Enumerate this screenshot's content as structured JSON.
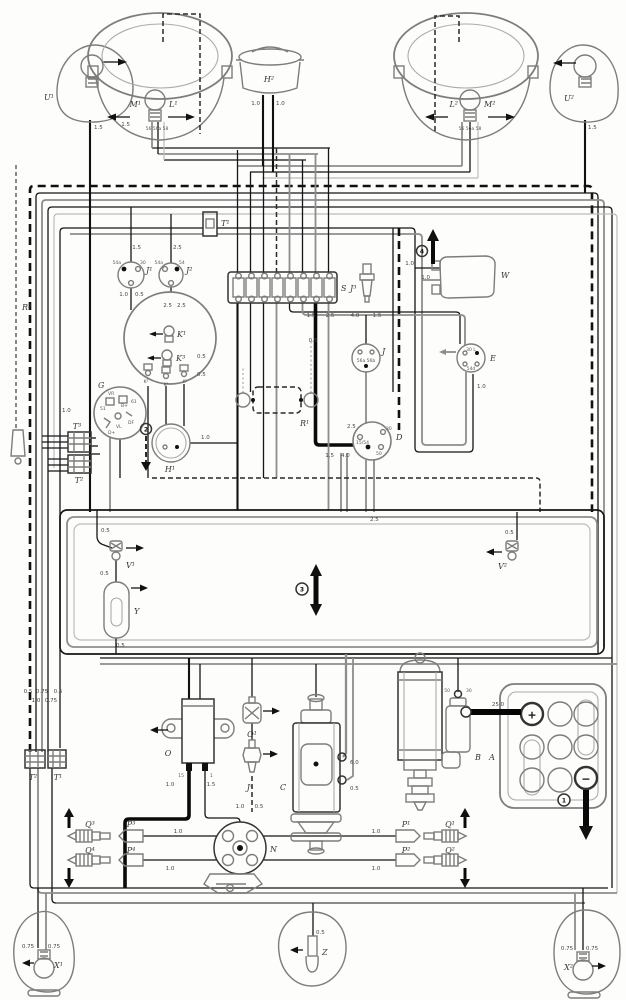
{
  "diagram": {
    "type": "wiring-schematic",
    "subject": "Volkswagen Type 1 (Beetle) electrical wiring diagram"
  },
  "components": {
    "front_turn_left": {
      "label": "U¹"
    },
    "front_turn_right": {
      "label": "U²"
    },
    "headlight_left": {
      "dim_bulb": "M¹",
      "main_bulb": "L¹",
      "terminals": "56 56a 58"
    },
    "headlight_right": {
      "main_bulb": "L²",
      "dim_bulb": "M²",
      "terminals": "56 56a 58"
    },
    "horn": {
      "label": "H²"
    },
    "horn_ring": {
      "label": "H¹"
    },
    "antenna": {
      "label": "R²"
    },
    "radio": {
      "label": "R¹"
    },
    "connector_top": {
      "label": "T¹"
    },
    "switch_j1": {
      "label": "J¹",
      "t_left": "54a",
      "t_right": "30"
    },
    "switch_j2": {
      "label": "J²",
      "t_left": "54a",
      "t_right": "54"
    },
    "fusebox": {
      "label": "S"
    },
    "plug_j3": {
      "label": "J³"
    },
    "wiper_motor": {
      "label": "W"
    },
    "wiper_switch": {
      "label": "E",
      "t_top": "30 L",
      "t_bottom": "54d"
    },
    "speedometer": {
      "lamp1": "K¹",
      "lamp2": "K³",
      "t1": "K²",
      "t2": "K⁴",
      "t3": "K⁵"
    },
    "dimmer_switch": {
      "label": "J",
      "terminals": "56a 56b"
    },
    "regulator": {
      "group": "G",
      "label": "VR",
      "t51": "51",
      "tbplus": "B+",
      "t61": "61",
      "tdf": "DF",
      "tdplus": "D+",
      "tvl": "VL"
    },
    "connector_t3": {
      "label": "T³"
    },
    "connector_t2": {
      "label": "T²"
    },
    "ignition_switch": {
      "label": "D",
      "t30": "30",
      "t1554": "15/54",
      "t50": "50"
    },
    "sender_v1": {
      "label": "V¹"
    },
    "sender_v2": {
      "label": "V²"
    },
    "semaphore": {
      "label": "Y"
    },
    "coil": {
      "label": "O",
      "t15": "15",
      "t1": "1"
    },
    "sender_o1": {
      "label": "O¹"
    },
    "sender_j4": {
      "label": "J⁴"
    },
    "generator": {
      "label": "C"
    },
    "starter": {
      "label": "B",
      "t50": "50",
      "t30": "30"
    },
    "battery": {
      "label": "A",
      "plus": "+",
      "minus": "−"
    },
    "distributor": {
      "label": "N"
    },
    "plug_connectors": {
      "p1": "P¹",
      "p2": "P²",
      "p3": "P³",
      "p4": "P⁴"
    },
    "spark_plugs": {
      "q1": "Q¹",
      "q2": "Q²",
      "q3": "Q³",
      "q4": "Q⁴"
    },
    "connector_t2b": {
      "label": "T²"
    },
    "connector_t1b": {
      "label": "T¹"
    },
    "tail_left": {
      "label": "X¹"
    },
    "tail_right": {
      "label": "X²"
    },
    "plate_light": {
      "label": "Z"
    }
  },
  "grounds": {
    "g1": "1",
    "g2": "2",
    "g3": "3",
    "g4": "4"
  },
  "wire_gauges": {
    "g05": "0.5",
    "g075": "0.75",
    "g10": "1.0",
    "g15": "1.5",
    "g25": "2.5",
    "g40": "4.0",
    "g60": "6.0",
    "g250": "25.0"
  },
  "fuse_row": [
    "1.5",
    "2.5",
    "4.0",
    "1.5"
  ]
}
